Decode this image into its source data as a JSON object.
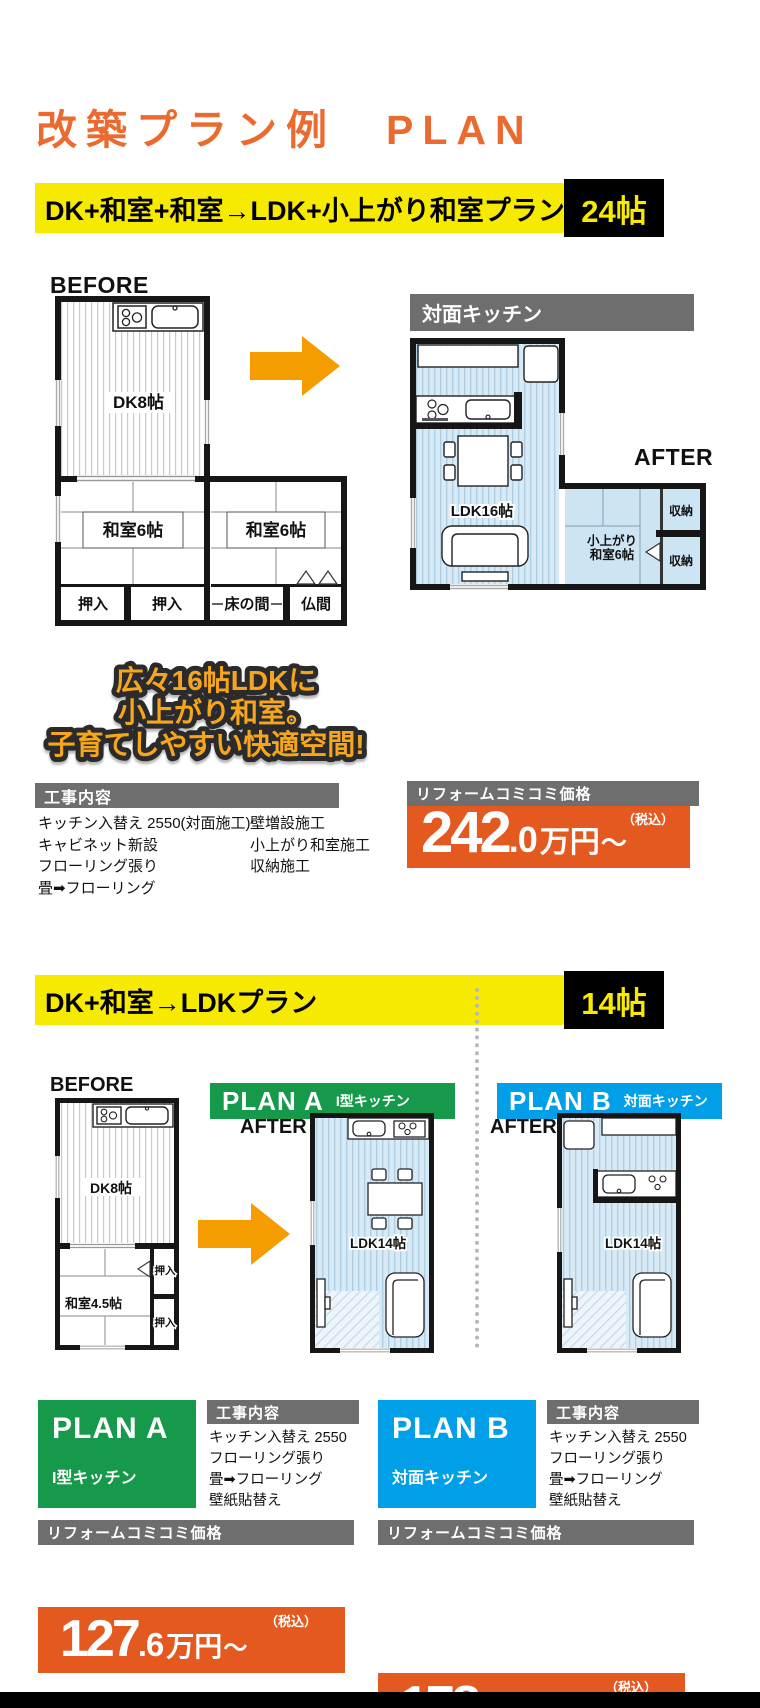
{
  "title": "改築プラン例　PLAN",
  "s1": {
    "banner": {
      "label": "DK+和室+和室→LDK+小上がり和室プラン",
      "size": "24帖"
    },
    "before": {
      "label": "BEFORE",
      "dk": "DK8帖",
      "w1": "和室6帖",
      "w2": "和室6帖",
      "oshiire1": "押入",
      "oshiire2": "押入",
      "tokonoma": "床の間",
      "butsuma": "仏間"
    },
    "after": {
      "label": "AFTER",
      "tag": "対面キッチン",
      "ldk": "LDK16帖",
      "koagari1": "小上がり",
      "koagari2": "和室6帖",
      "storage1": "収納",
      "storage2": "収納"
    },
    "catch": [
      "広々16帖LDKに",
      "小上がり和室。",
      "子育てしやすい快適空間!"
    ],
    "works": {
      "header": "工事内容",
      "col1": [
        "キッチン入替え 2550(対面施工)",
        "キャビネット新設",
        "フローリング張り",
        "畳➡フローリング"
      ],
      "col2": [
        "壁増設施工",
        "小上がり和室施工",
        "収納施工"
      ]
    },
    "price": {
      "header": "リフォームコミコミ価格",
      "tax": "（税込）",
      "main": "242",
      "decimal": ".0",
      "unit": "万円",
      "tilde": "〜"
    }
  },
  "s2": {
    "banner": {
      "label": "DK+和室→LDKプラン",
      "size": "14帖"
    },
    "before": {
      "label": "BEFORE",
      "dk": "DK8帖",
      "w": "和室4.5帖",
      "oshiire1": "押入",
      "oshiire2": "押入"
    },
    "planA": {
      "name": "PLAN A",
      "type": "I型キッチン",
      "after": "AFTER",
      "room": "LDK14帖",
      "works": {
        "header": "工事内容",
        "items": [
          "キッチン入替え 2550",
          "フローリング張り",
          "畳➡フローリング",
          "壁紙貼替え"
        ]
      },
      "price": {
        "header": "リフォームコミコミ価格",
        "tax": "（税込）",
        "main": "127",
        "decimal": ".6",
        "unit": "万円",
        "tilde": "〜"
      }
    },
    "planB": {
      "name": "PLAN B",
      "type": "対面キッチン",
      "after": "AFTER",
      "room": "LDK14帖",
      "works": {
        "header": "工事内容",
        "items": [
          "キッチン入替え 2550",
          "フローリング張り",
          "畳➡フローリング",
          "壁紙貼替え"
        ]
      },
      "price": {
        "header": "リフォームコミコミ価格",
        "tax": "（税込）",
        "main": "178",
        "decimal": ".2",
        "unit": "万円",
        "tilde": "〜"
      }
    }
  }
}
